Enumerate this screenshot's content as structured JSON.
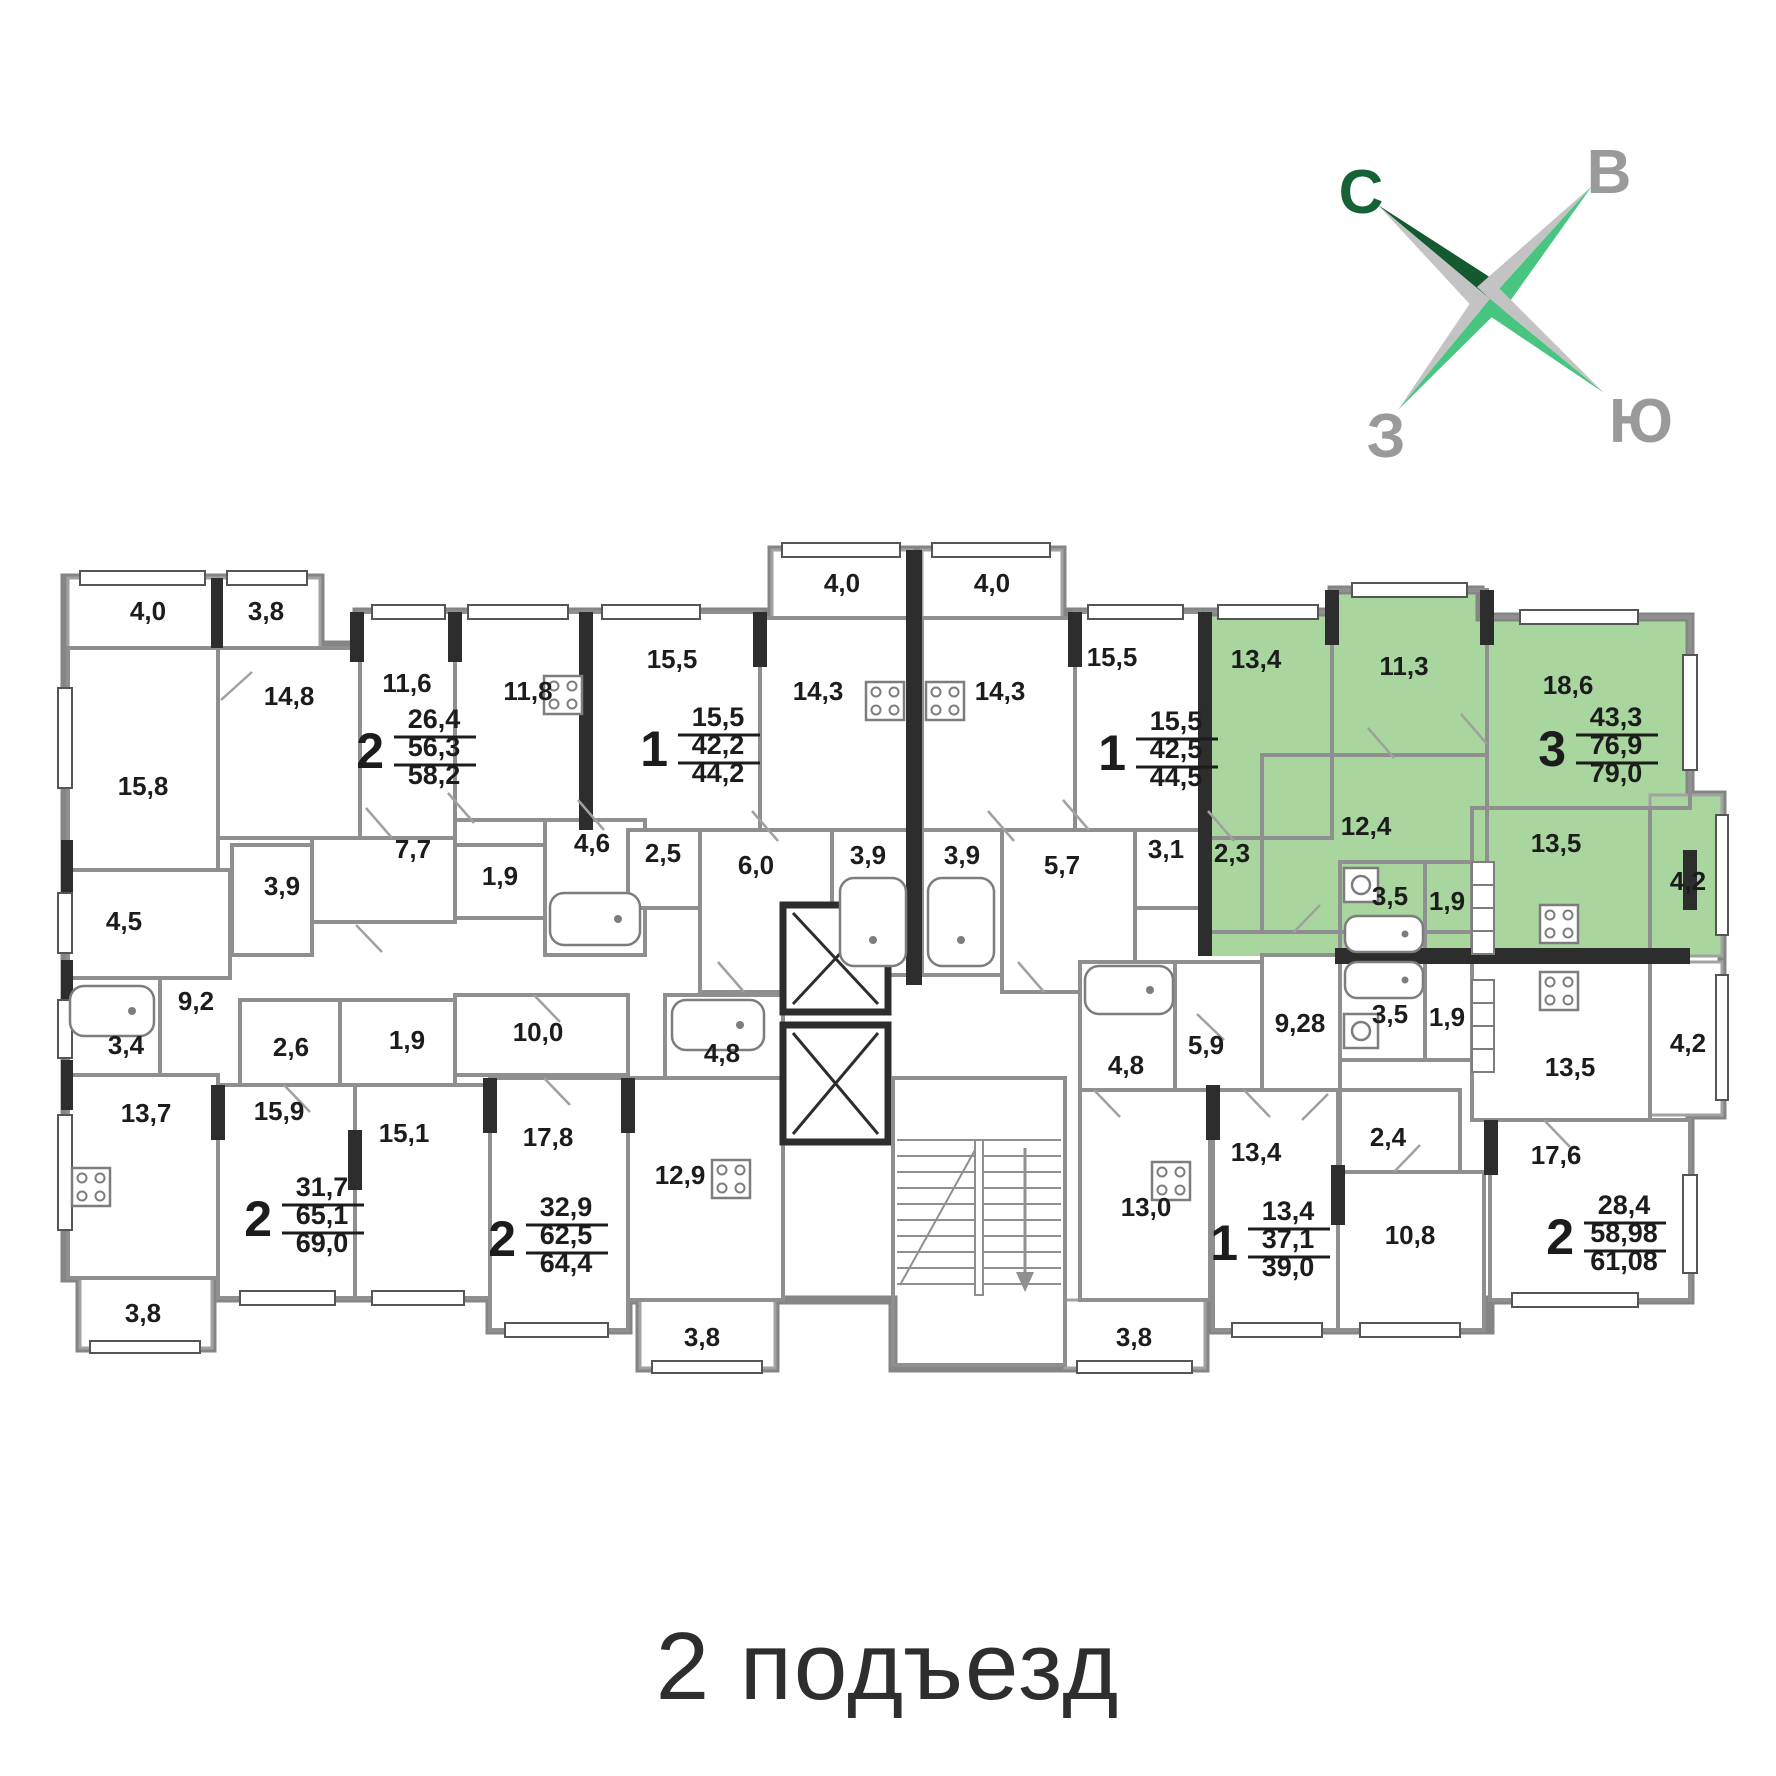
{
  "title": "2 подъезд",
  "colors": {
    "highlight_green": "#a8d69e",
    "wall_gray": "#8f8f8f",
    "wall_dark": "#2d2d2d",
    "text_dark": "#1c1c1c",
    "compass_dark_green": "#14592f",
    "compass_bright_green": "#47c581",
    "compass_gray_blade": "#c3c3c3",
    "compass_letter_green": "#166136",
    "compass_letter_gray": "#9a9a9a"
  },
  "compass": {
    "north": "С",
    "east": "В",
    "west": "З",
    "south": "Ю"
  },
  "rooms": [
    {
      "area": "4,0",
      "x": 148,
      "y": 620
    },
    {
      "area": "3,8",
      "x": 266,
      "y": 620
    },
    {
      "area": "15,8",
      "x": 143,
      "y": 795
    },
    {
      "area": "14,8",
      "x": 289,
      "y": 705
    },
    {
      "area": "11,6",
      "x": 407,
      "y": 692
    },
    {
      "area": "11,8",
      "x": 528,
      "y": 700
    },
    {
      "area": "15,5",
      "x": 672,
      "y": 668
    },
    {
      "area": "14,3",
      "x": 818,
      "y": 700
    },
    {
      "area": "4,0",
      "x": 842,
      "y": 592
    },
    {
      "area": "4,0",
      "x": 992,
      "y": 592
    },
    {
      "area": "14,3",
      "x": 1000,
      "y": 700
    },
    {
      "area": "15,5",
      "x": 1112,
      "y": 666
    },
    {
      "area": "13,4",
      "x": 1256,
      "y": 668
    },
    {
      "area": "11,3",
      "x": 1404,
      "y": 675
    },
    {
      "area": "18,6",
      "x": 1568,
      "y": 694
    },
    {
      "area": "7,7",
      "x": 413,
      "y": 858
    },
    {
      "area": "3,9",
      "x": 282,
      "y": 895
    },
    {
      "area": "1,9",
      "x": 500,
      "y": 885
    },
    {
      "area": "4,6",
      "x": 592,
      "y": 852
    },
    {
      "area": "2,5",
      "x": 663,
      "y": 862
    },
    {
      "area": "6,0",
      "x": 756,
      "y": 874
    },
    {
      "area": "3,9",
      "x": 868,
      "y": 864
    },
    {
      "area": "3,9",
      "x": 962,
      "y": 864
    },
    {
      "area": "5,7",
      "x": 1062,
      "y": 874
    },
    {
      "area": "3,1",
      "x": 1166,
      "y": 858
    },
    {
      "area": "2,3",
      "x": 1232,
      "y": 862
    },
    {
      "area": "12,4",
      "x": 1366,
      "y": 835
    },
    {
      "area": "3,5",
      "x": 1390,
      "y": 905
    },
    {
      "area": "1,9",
      "x": 1447,
      "y": 910
    },
    {
      "area": "13,5",
      "x": 1556,
      "y": 852
    },
    {
      "area": "4,2",
      "x": 1688,
      "y": 890
    },
    {
      "area": "4,5",
      "x": 124,
      "y": 930
    },
    {
      "area": "9,2",
      "x": 196,
      "y": 1010
    },
    {
      "area": "3,4",
      "x": 126,
      "y": 1054
    },
    {
      "area": "13,7",
      "x": 146,
      "y": 1122
    },
    {
      "area": "2,6",
      "x": 291,
      "y": 1056
    },
    {
      "area": "1,9",
      "x": 407,
      "y": 1049
    },
    {
      "area": "10,0",
      "x": 538,
      "y": 1041
    },
    {
      "area": "4,8",
      "x": 722,
      "y": 1062
    },
    {
      "area": "15,9",
      "x": 279,
      "y": 1120
    },
    {
      "area": "15,1",
      "x": 404,
      "y": 1142
    },
    {
      "area": "17,8",
      "x": 548,
      "y": 1146
    },
    {
      "area": "12,9",
      "x": 680,
      "y": 1184
    },
    {
      "area": "9,28",
      "x": 1300,
      "y": 1032
    },
    {
      "area": "3,5",
      "x": 1390,
      "y": 1023
    },
    {
      "area": "1,9",
      "x": 1447,
      "y": 1026
    },
    {
      "area": "13,5",
      "x": 1570,
      "y": 1076
    },
    {
      "area": "4,2",
      "x": 1688,
      "y": 1052
    },
    {
      "area": "4,8",
      "x": 1126,
      "y": 1074
    },
    {
      "area": "5,9",
      "x": 1206,
      "y": 1054
    },
    {
      "area": "13,0",
      "x": 1146,
      "y": 1216
    },
    {
      "area": "13,4",
      "x": 1256,
      "y": 1161
    },
    {
      "area": "2,4",
      "x": 1388,
      "y": 1146
    },
    {
      "area": "10,8",
      "x": 1410,
      "y": 1244
    },
    {
      "area": "17,6",
      "x": 1556,
      "y": 1164
    },
    {
      "area": "3,8",
      "x": 143,
      "y": 1322
    },
    {
      "area": "3,8",
      "x": 702,
      "y": 1346
    },
    {
      "area": "3,8",
      "x": 1134,
      "y": 1346
    }
  ],
  "apartments": [
    {
      "type": "2",
      "living": "26,4",
      "area": "56,3",
      "total": "58,2",
      "x": 384,
      "y": 750,
      "highlight": false
    },
    {
      "type": "1",
      "living": "15,5",
      "area": "42,2",
      "total": "44,2",
      "x": 668,
      "y": 748,
      "highlight": false
    },
    {
      "type": "1",
      "living": "15,5",
      "area": "42,5",
      "total": "44,5",
      "x": 1126,
      "y": 752,
      "highlight": false
    },
    {
      "type": "3",
      "living": "43,3",
      "area": "76,9",
      "total": "79,0",
      "x": 1566,
      "y": 748,
      "highlight": true
    },
    {
      "type": "2",
      "living": "31,7",
      "area": "65,1",
      "total": "69,0",
      "x": 272,
      "y": 1218,
      "highlight": false
    },
    {
      "type": "2",
      "living": "32,9",
      "area": "62,5",
      "total": "64,4",
      "x": 516,
      "y": 1238,
      "highlight": false
    },
    {
      "type": "1",
      "living": "13,4",
      "area": "37,1",
      "total": "39,0",
      "x": 1238,
      "y": 1242,
      "highlight": false
    },
    {
      "type": "2",
      "living": "28,4",
      "area": "58,98",
      "total": "61,08",
      "x": 1574,
      "y": 1236,
      "highlight": false
    }
  ]
}
